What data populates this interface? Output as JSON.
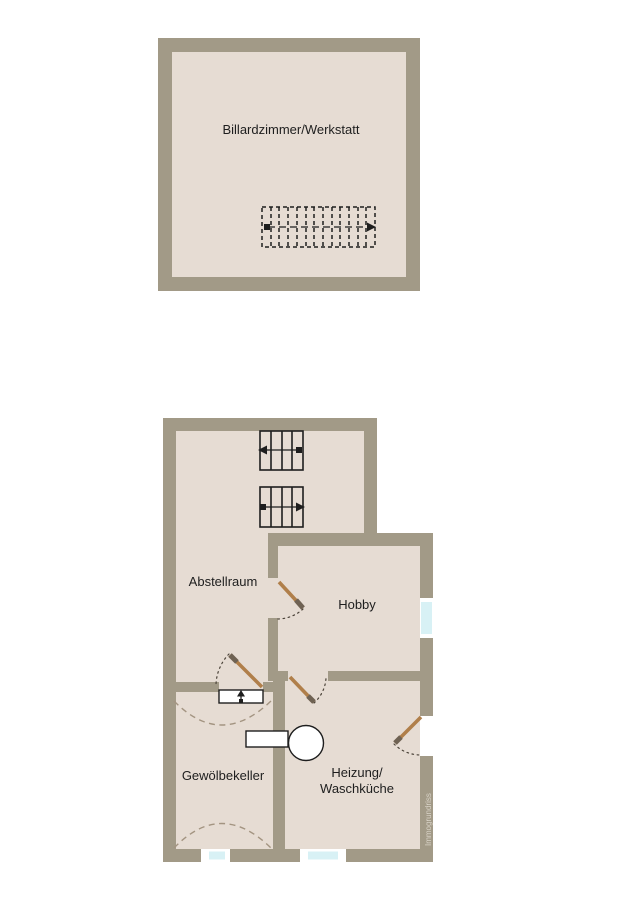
{
  "colors": {
    "bg": "#ffffff",
    "wall": "#a29a87",
    "room": "#e6dcd3",
    "ink": "#1e1e1e",
    "doorleaf": "#b07f4a",
    "doorhandle": "#6f6253",
    "doorswing": "#4a4238",
    "vault": "#a39481",
    "glass": "#d8f1f5",
    "frame": "#ffffff",
    "watermark": "#d9d3c7"
  },
  "rooms": {
    "billiard": "Billardzimmer/Werkstatt",
    "storage": "Abstellraum",
    "hobby": "Hobby",
    "vault_cellar": "Gewölbekeller",
    "heating_line1": "Heizung/",
    "heating_line2": "Waschküche"
  },
  "watermark": "Immogrundriss"
}
